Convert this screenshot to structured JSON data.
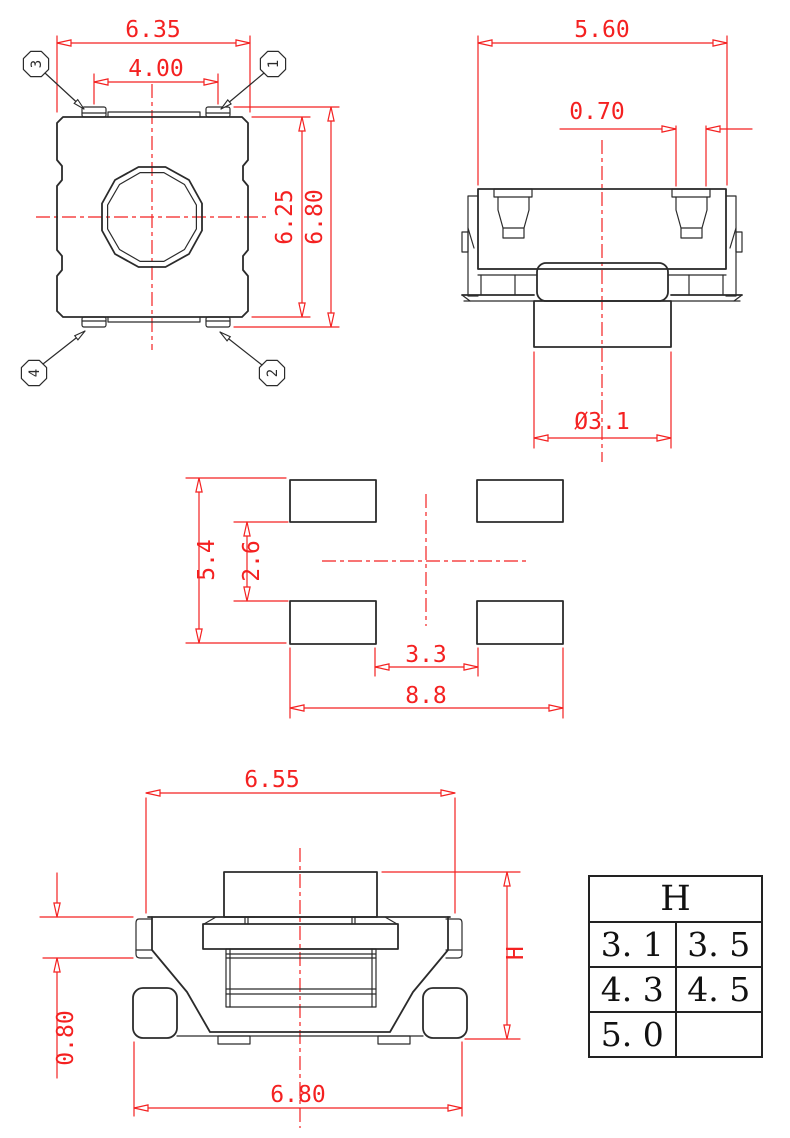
{
  "colors": {
    "dimension_red": "#f42121",
    "outline_black": "#2b2b2b"
  },
  "top_view": {
    "dim_width": "6.35",
    "dim_pin_span": "4.00",
    "dim_body_height": "6.25",
    "dim_overall_height": "6.80",
    "pin_labels": {
      "b1": "1",
      "b2": "2",
      "b3": "3",
      "b4": "4"
    }
  },
  "side_view": {
    "dim_width": "5.60",
    "dim_terminal_width": "0.70",
    "dim_stem_diameter": "Ø3.1"
  },
  "land_pattern": {
    "dim_outer_vertical": "5.4",
    "dim_inner_vertical": "2.6",
    "dim_inner_horizontal": "3.3",
    "dim_outer_horizontal": "8.8"
  },
  "front_view": {
    "dim_top_width": "6.55",
    "dim_bottom_width": "6.80",
    "dim_terminal_height": "0.80",
    "dim_height_label": "H"
  },
  "height_table": {
    "header": "H",
    "rows": [
      [
        "3. 1",
        "3. 5"
      ],
      [
        "4. 3",
        "4. 5"
      ],
      [
        "5. 0",
        ""
      ]
    ]
  }
}
